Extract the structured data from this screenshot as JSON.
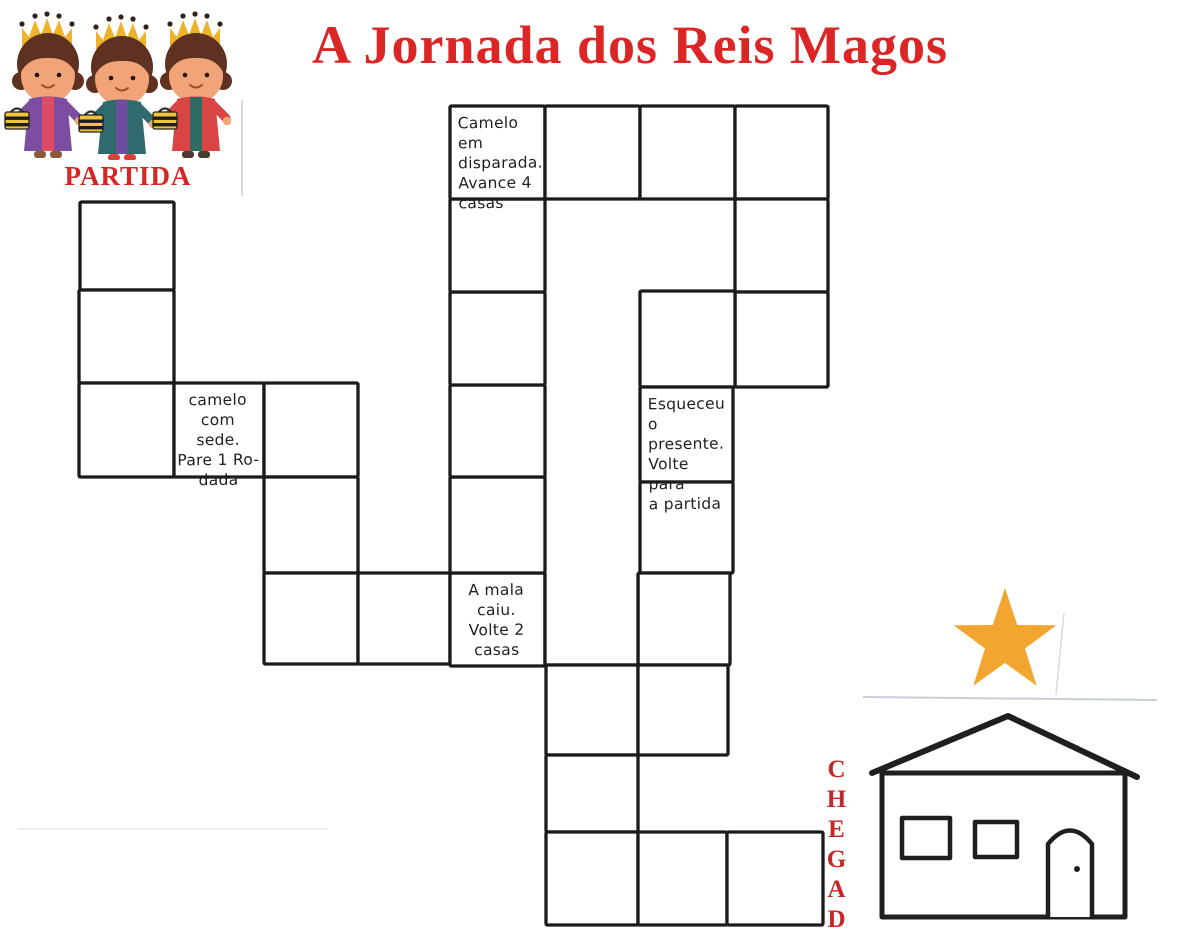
{
  "title": "A Jornada dos Reis Magos",
  "labels": {
    "start": "PARTIDA",
    "finish": "CHEGADA"
  },
  "colors": {
    "title_red": "#DC2626",
    "start_label_red": "#D32726",
    "finish_label_red": "#C32727",
    "board_ink": "#1b1b1b",
    "star_orange": "#F2A52F",
    "crown_gold": "#EEB32B",
    "gift_yellow": "#EFC33A"
  },
  "icons": {
    "top_left": "three-wise-men-illustration",
    "finish_star": "star-of-bethlehem-icon",
    "finish_house": "bethlehem-house-illustration"
  },
  "board": {
    "ink": "#1b1b1b",
    "cells": [
      {
        "id": "start-1",
        "x": 80,
        "y": 202,
        "w": 94,
        "h": 88
      },
      {
        "id": "start-2",
        "x": 79,
        "y": 290,
        "w": 95,
        "h": 93
      },
      {
        "id": "start-3",
        "x": 79,
        "y": 383,
        "w": 95,
        "h": 94
      },
      {
        "id": "camel-thirsty",
        "x": 174,
        "y": 383,
        "w": 90,
        "h": 94,
        "text": "camelo com sede. Pare 1 rodada",
        "lines": [
          "camelo com",
          "sede.",
          "Pare 1 Ro-",
          "dada"
        ]
      },
      {
        "id": "c4",
        "x": 264,
        "y": 383,
        "w": 94,
        "h": 94
      },
      {
        "id": "c5",
        "x": 264,
        "y": 477,
        "w": 94,
        "h": 96
      },
      {
        "id": "c6",
        "x": 264,
        "y": 573,
        "w": 94,
        "h": 91
      },
      {
        "id": "d6",
        "x": 358,
        "y": 573,
        "w": 92,
        "h": 91
      },
      {
        "id": "suitcase-fell",
        "x": 450,
        "y": 573,
        "w": 95,
        "h": 93,
        "text": "A mala caiu. Volte 2 casas",
        "lines": [
          "A mala",
          "caiu.",
          "Volte 2",
          "casas"
        ]
      },
      {
        "id": "e5",
        "x": 450,
        "y": 477,
        "w": 95,
        "h": 96
      },
      {
        "id": "e4",
        "x": 450,
        "y": 385,
        "w": 95,
        "h": 92
      },
      {
        "id": "e3",
        "x": 450,
        "y": 292,
        "w": 95,
        "h": 93
      },
      {
        "id": "e2",
        "x": 450,
        "y": 199,
        "w": 95,
        "h": 93
      },
      {
        "id": "camel-rush",
        "x": 450,
        "y": 106,
        "w": 95,
        "h": 93,
        "align": "left",
        "text": "Camelo em disparada. Avance 4 casas",
        "lines": [
          "Camelo em",
          "disparada.",
          "Avance 4",
          "casas"
        ]
      },
      {
        "id": "f1",
        "x": 545,
        "y": 106,
        "w": 95,
        "h": 93
      },
      {
        "id": "g1",
        "x": 640,
        "y": 106,
        "w": 95,
        "h": 93
      },
      {
        "id": "h1",
        "x": 735,
        "y": 106,
        "w": 93,
        "h": 93
      },
      {
        "id": "h2",
        "x": 735,
        "y": 199,
        "w": 93,
        "h": 93
      },
      {
        "id": "h3",
        "x": 735,
        "y": 292,
        "w": 93,
        "h": 95
      },
      {
        "id": "g3",
        "x": 640,
        "y": 291,
        "w": 95,
        "h": 96
      },
      {
        "id": "forgot-gift",
        "x": 640,
        "y": 387,
        "w": 93,
        "h": 95,
        "align": "left",
        "text": "Esqueceu o presente. Volte para a partida",
        "lines": [
          "Esqueceu",
          "o presente.",
          "Volte para",
          "a partida"
        ]
      },
      {
        "id": "g5",
        "x": 640,
        "y": 482,
        "w": 93,
        "h": 91
      },
      {
        "id": "g6",
        "x": 638,
        "y": 573,
        "w": 92,
        "h": 92
      },
      {
        "id": "f6",
        "x": 545,
        "y": 575,
        "w": 93,
        "h": 90,
        "open_top": true
      },
      {
        "id": "f7",
        "x": 546,
        "y": 665,
        "w": 92,
        "h": 90
      },
      {
        "id": "g7",
        "x": 638,
        "y": 665,
        "w": 90,
        "h": 90
      },
      {
        "id": "f8",
        "x": 546,
        "y": 755,
        "w": 92,
        "h": 77
      },
      {
        "id": "f9",
        "x": 546,
        "y": 832,
        "w": 92,
        "h": 93
      },
      {
        "id": "g9",
        "x": 638,
        "y": 832,
        "w": 89,
        "h": 93
      },
      {
        "id": "h9",
        "x": 727,
        "y": 832,
        "w": 96,
        "h": 93
      }
    ]
  }
}
